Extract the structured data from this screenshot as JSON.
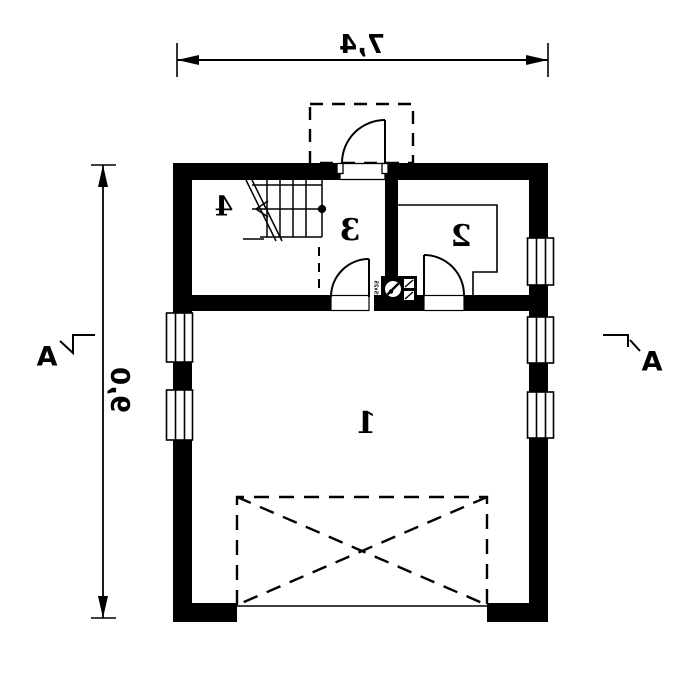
{
  "plan": {
    "dimensions": {
      "width": "7,4",
      "height": "9,0"
    },
    "section_markers": {
      "left": "A",
      "right": "A"
    },
    "rooms": {
      "room1": "1",
      "room2": "2",
      "room3": "3",
      "room4": "4"
    },
    "stove_label": "25x25",
    "colors": {
      "line": "#000000",
      "background": "#ffffff"
    }
  }
}
